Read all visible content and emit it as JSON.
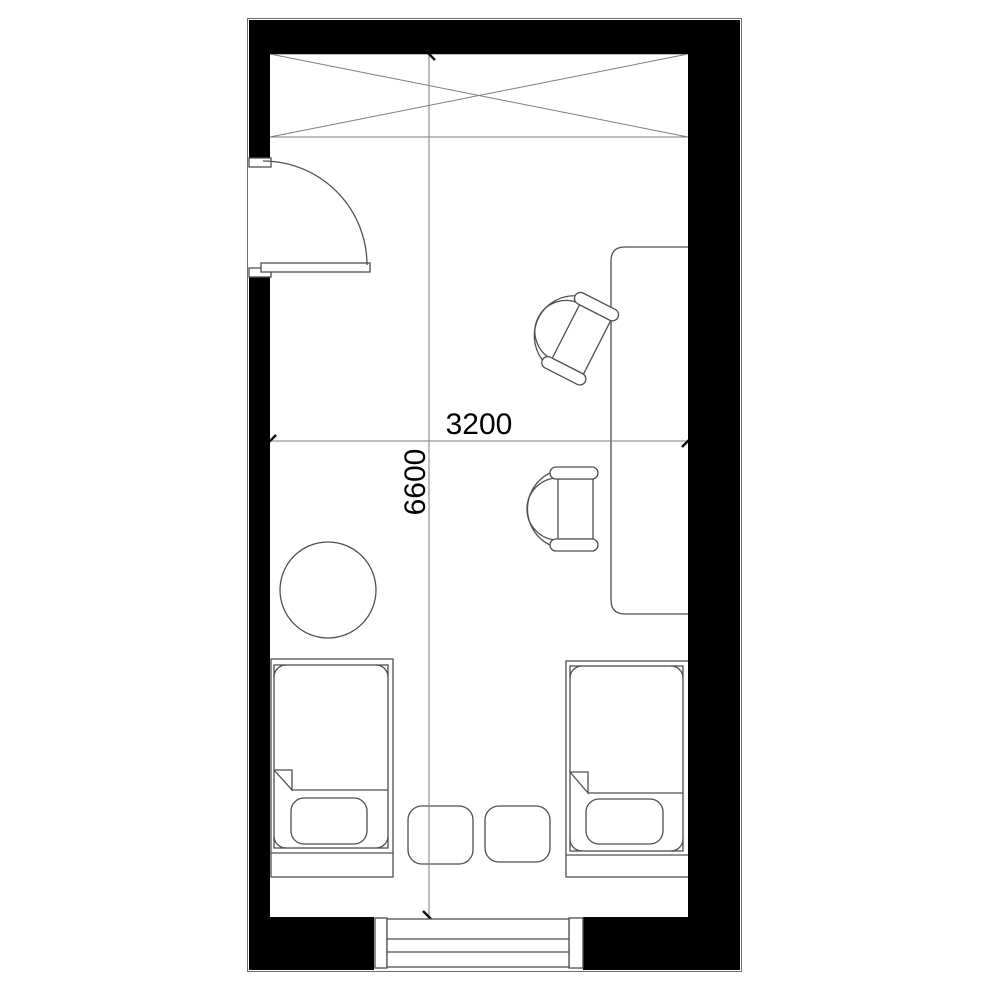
{
  "plan": {
    "type": "architectural-floor-plan",
    "dimension_labels": {
      "horizontal": "3200",
      "vertical": "6600"
    },
    "colors": {
      "wall": "#000000",
      "floor": "#ffffff",
      "furniture_line": "#4f4f4f",
      "dim_line": "#7d7d7d",
      "outline": "#6e6e6e",
      "tick": "#111111",
      "text": "#000000"
    },
    "symbols": [
      "wardrobe-crossed-box",
      "entry-door-with-swing-arc",
      "long-desk",
      "office-chair-upper",
      "office-chair-lower",
      "round-table",
      "bed-left-with-pillow",
      "bed-right-with-pillow",
      "stool-left",
      "stool-right",
      "window-bottom"
    ]
  }
}
